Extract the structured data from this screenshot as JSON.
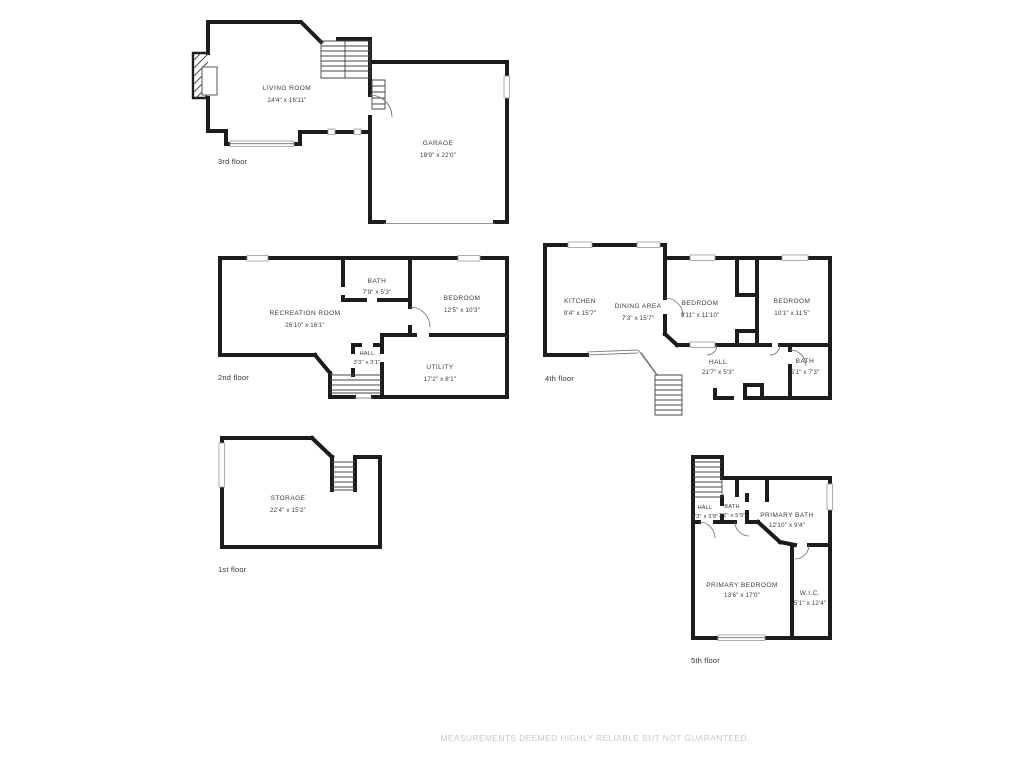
{
  "disclaimer": "MEASUREMENTS DEEMED HIGHLY RELIABLE BUT NOT GUARANTEED.",
  "colors": {
    "wall": "#1c1c1c",
    "thin_line": "#6e6e6e",
    "window_border": "#9a9a9a",
    "room_label": "#3a3a3a",
    "floor_label": "#333333",
    "disclaimer_text": "#c9c9c9"
  },
  "floors": {
    "first": {
      "label": "1st floor",
      "rooms": {
        "storage": {
          "name": "STORAGE",
          "dims": "22'4\" x 15'2\""
        }
      }
    },
    "second": {
      "label": "2nd floor",
      "rooms": {
        "recreation_room": {
          "name": "RECREATION ROOM",
          "dims": "26'10\" x 16'1\""
        },
        "bath": {
          "name": "BATH",
          "dims": "7'9\" x 5'3\""
        },
        "bedroom": {
          "name": "BEDROOM",
          "dims": "12'5\" x 10'3\""
        },
        "hall": {
          "name": "HALL",
          "dims": "3'3\" x 3'1\""
        },
        "utility": {
          "name": "UTILITY",
          "dims": "17'2\" x 8'1\""
        }
      }
    },
    "third": {
      "label": "3rd floor",
      "rooms": {
        "living_room": {
          "name": "LIVING ROOM",
          "dims": "24'4\" x 16'11\""
        },
        "garage": {
          "name": "GARAGE",
          "dims": "18'9\" x 22'0\""
        }
      }
    },
    "fourth": {
      "label": "4th floor",
      "rooms": {
        "kitchen": {
          "name": "KITCHEN",
          "dims": "9'4\" x 15'7\""
        },
        "dining_area": {
          "name": "DINING AREA",
          "dims": "7'3\" x 15'7\""
        },
        "bedroom_left": {
          "name": "BEDROOM",
          "dims": "9'11\" x 11'10\""
        },
        "bedroom_right": {
          "name": "BEDROOM",
          "dims": "10'1\" x 11'5\""
        },
        "hall": {
          "name": "HALL",
          "dims": "21'7\" x 5'3\""
        },
        "bath": {
          "name": "BATH",
          "dims": "5'1\" x 7'3\""
        }
      }
    },
    "fifth": {
      "label": "5th floor",
      "rooms": {
        "hall": {
          "name": "HALL",
          "dims": "9'3\" x 3'8\""
        },
        "bath": {
          "name": "BATH",
          "dims": "7'2\" x 5'9\""
        },
        "primary_bath": {
          "name": "PRIMARY BATH",
          "dims": "12'10\" x 9'4\""
        },
        "primary_bedroom": {
          "name": "PRIMARY BEDROOM",
          "dims": "13'6\" x 17'0\""
        },
        "wic": {
          "name": "W.I.C.",
          "dims": "5'1\" x 12'4\""
        }
      }
    }
  }
}
